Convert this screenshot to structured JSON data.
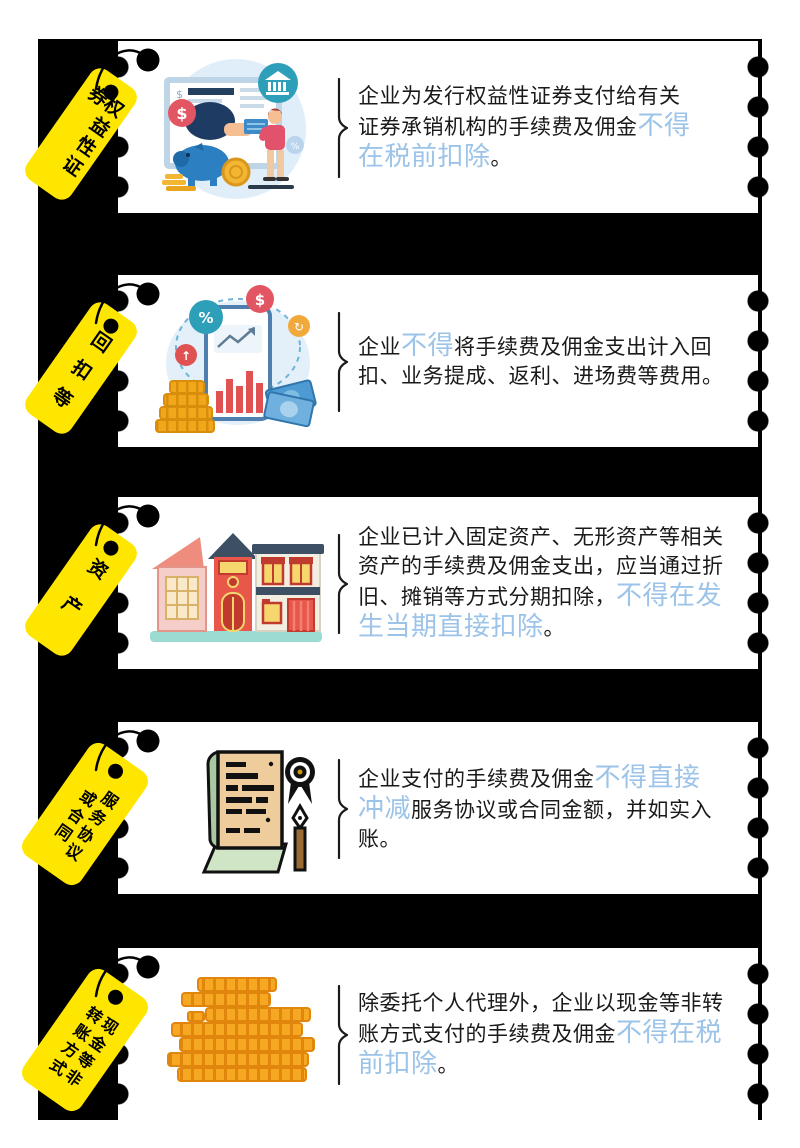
{
  "colors": {
    "panel_background": "#000000",
    "card_background": "#FFFFFF",
    "tag_yellow": "#FFE600",
    "highlight_blue": "#9CC3E8",
    "body_text": "#1A1A1A"
  },
  "rows": [
    {
      "tag": {
        "label": "权益性证券",
        "columns": [
          "权益性证券"
        ]
      },
      "illustration": "securities-underwriting-payment-illustration",
      "lines": [
        {
          "segments": [
            {
              "text": "企业为发行权益性证券支付给有关",
              "style": "normal"
            }
          ]
        },
        {
          "segments": [
            {
              "text": "证券承销机构的手续费及佣金",
              "style": "normal"
            },
            {
              "text": "不得",
              "style": "highlight"
            }
          ]
        },
        {
          "segments": [
            {
              "text": "在税前扣除",
              "style": "highlight"
            },
            {
              "text": "。",
              "style": "normal"
            }
          ]
        }
      ]
    },
    {
      "tag": {
        "label": "回扣等",
        "columns": [
          "回扣等"
        ]
      },
      "illustration": "phone-chart-coins-rebate-illustration",
      "lines": [
        {
          "segments": [
            {
              "text": "企业",
              "style": "normal"
            },
            {
              "text": "不得",
              "style": "highlight"
            },
            {
              "text": "将手续费及佣金支出计入回",
              "style": "normal"
            }
          ]
        },
        {
          "segments": [
            {
              "text": "扣、业务提成、返利、进场费等费用。",
              "style": "normal"
            }
          ]
        }
      ]
    },
    {
      "tag": {
        "label": "资产",
        "columns": [
          "资产"
        ]
      },
      "illustration": "buildings-fixed-assets-illustration",
      "lines": [
        {
          "segments": [
            {
              "text": "企业已计入固定资产、无形资产等相关",
              "style": "normal"
            }
          ]
        },
        {
          "segments": [
            {
              "text": "资产的手续费及佣金支出，应当通过折",
              "style": "normal"
            }
          ]
        },
        {
          "segments": [
            {
              "text": "旧、摊销等方式分期扣除，",
              "style": "normal"
            },
            {
              "text": "不得在发",
              "style": "highlight"
            }
          ]
        },
        {
          "segments": [
            {
              "text": "生当期直接扣除",
              "style": "highlight"
            },
            {
              "text": "。",
              "style": "normal"
            }
          ]
        }
      ]
    },
    {
      "tag": {
        "label": "服务协议或合同",
        "columns": [
          "服务协议",
          "或合同"
        ]
      },
      "illustration": "contract-scroll-seal-pen-illustration",
      "lines": [
        {
          "segments": [
            {
              "text": "企业支付的手续费及佣金",
              "style": "normal"
            },
            {
              "text": "不得直接",
              "style": "highlight"
            }
          ]
        },
        {
          "segments": [
            {
              "text": "冲减",
              "style": "highlight"
            },
            {
              "text": "服务协议或合同金额，并如实入",
              "style": "normal"
            }
          ]
        },
        {
          "segments": [
            {
              "text": "账。",
              "style": "normal"
            }
          ]
        }
      ]
    },
    {
      "tag": {
        "label": "现金等非转账方式",
        "columns": [
          "现金等非",
          "转账方式"
        ]
      },
      "illustration": "gold-coin-stacks-illustration",
      "lines": [
        {
          "segments": [
            {
              "text": "除委托个人代理外，企业以现金等非转",
              "style": "normal"
            }
          ]
        },
        {
          "segments": [
            {
              "text": "账方式支付的手续费及佣金",
              "style": "normal"
            },
            {
              "text": "不得在税",
              "style": "highlight"
            }
          ]
        },
        {
          "segments": [
            {
              "text": "前扣除",
              "style": "highlight"
            },
            {
              "text": "。",
              "style": "normal"
            }
          ]
        }
      ]
    }
  ]
}
